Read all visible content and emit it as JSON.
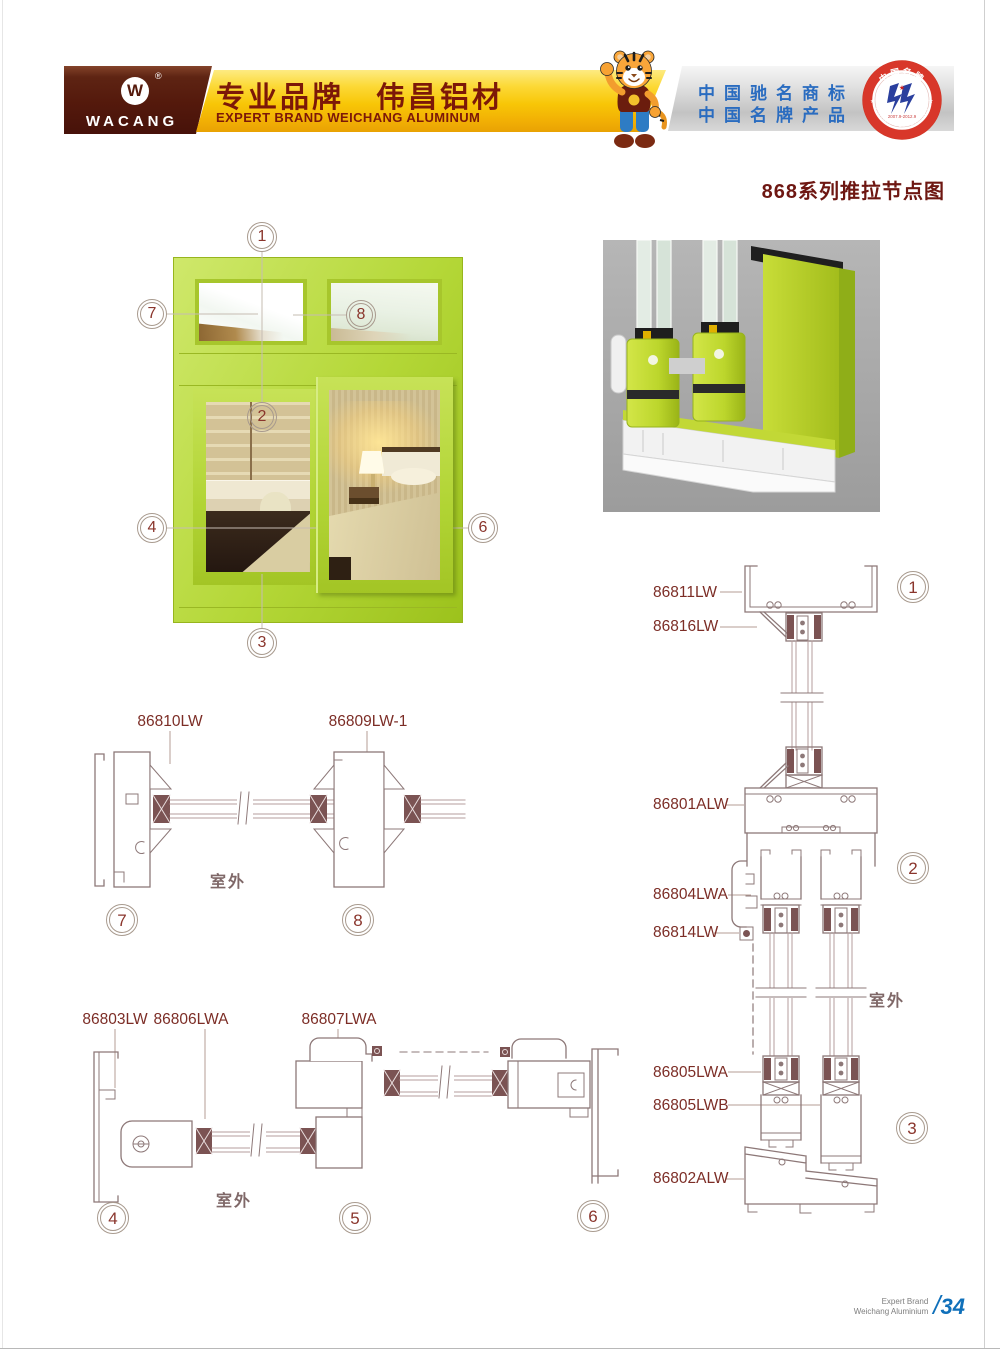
{
  "header": {
    "brand": "WACANG",
    "registered_mark": "®",
    "logo_letter": "W",
    "banner_title_cn": "专业品牌　伟昌铝材",
    "banner_subtitle_en": "EXPERT BRAND WEICHANG ALUMINUM",
    "honor_line1": "中国驰名商标",
    "honor_line2": "中国名牌产品",
    "seal_top": "中国名牌",
    "seal_bottom": "CHINA TOP BRAND",
    "seal_dates": "2007.9-2012.9"
  },
  "page": {
    "title": "868系列推拉节点图"
  },
  "window_figure": {
    "callouts": [
      "1",
      "2",
      "3",
      "4",
      "5",
      "6",
      "7",
      "8"
    ]
  },
  "diagrams": {
    "right": {
      "labels": [
        "86811LW",
        "86816LW",
        "86801ALW",
        "86804LWA",
        "86814LW",
        "86805LWA",
        "86805LWB",
        "86802ALW"
      ],
      "circles": [
        "1",
        "2",
        "3"
      ],
      "outdoor": "室外"
    },
    "mid_left": {
      "labels": [
        "86810LW",
        "86809LW-1"
      ],
      "circles": [
        "7",
        "8"
      ],
      "outdoor": "室外"
    },
    "bottom_left": {
      "labels": [
        "86803LW",
        "86806LWA",
        "86807LWA"
      ],
      "circles": [
        "4",
        "5",
        "6"
      ],
      "outdoor": "室外"
    }
  },
  "footer": {
    "line1": "Expert Brand",
    "line2": "Weichang Aluminium",
    "slash": "/",
    "page_number": "34"
  },
  "colors": {
    "frame_green": "#b5d93e",
    "title_maroon": "#6e1712",
    "banner_gold": "#f8c606",
    "honor_blue": "#2a6cc0",
    "footer_blue": "#1070ba",
    "drawing_line": "#8d7878"
  }
}
